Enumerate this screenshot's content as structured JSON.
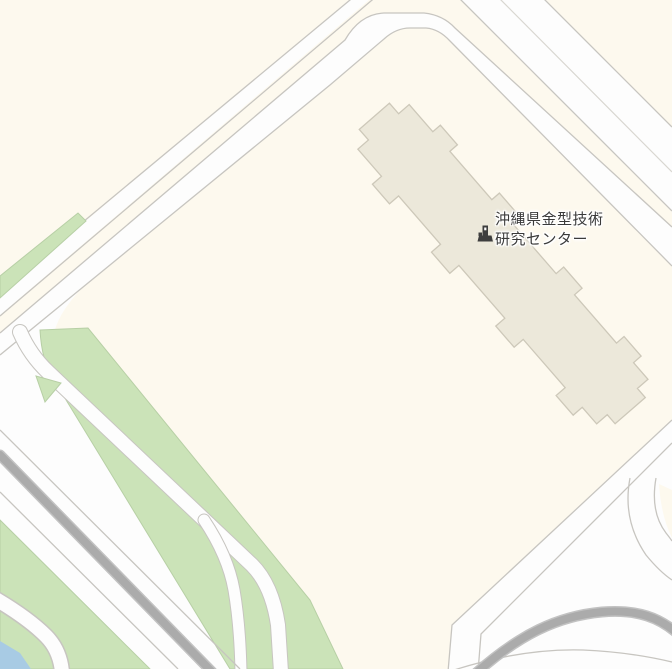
{
  "map": {
    "poi": {
      "label_line1": "沖縄県金型技術",
      "label_line2": "研究センター",
      "icon": "institution-building-icon"
    }
  },
  "colors": {
    "land": "#fdf9ee",
    "road_fill": "#fdfdfd",
    "road_casing": "#c7c5c0",
    "road_median": "#d8d6d0",
    "green": "#cbe3b8",
    "green_edge": "#b7cfa5",
    "water": "#a8cbe4",
    "highway": "#ababab",
    "highway_soft": "#c2c2c2",
    "building_fill": "#ece8da",
    "building_stroke": "#cdc8b9",
    "poi_icon": "#3e3e3e",
    "label_text": "#3a3a3a",
    "label_halo": "#ffffff"
  }
}
